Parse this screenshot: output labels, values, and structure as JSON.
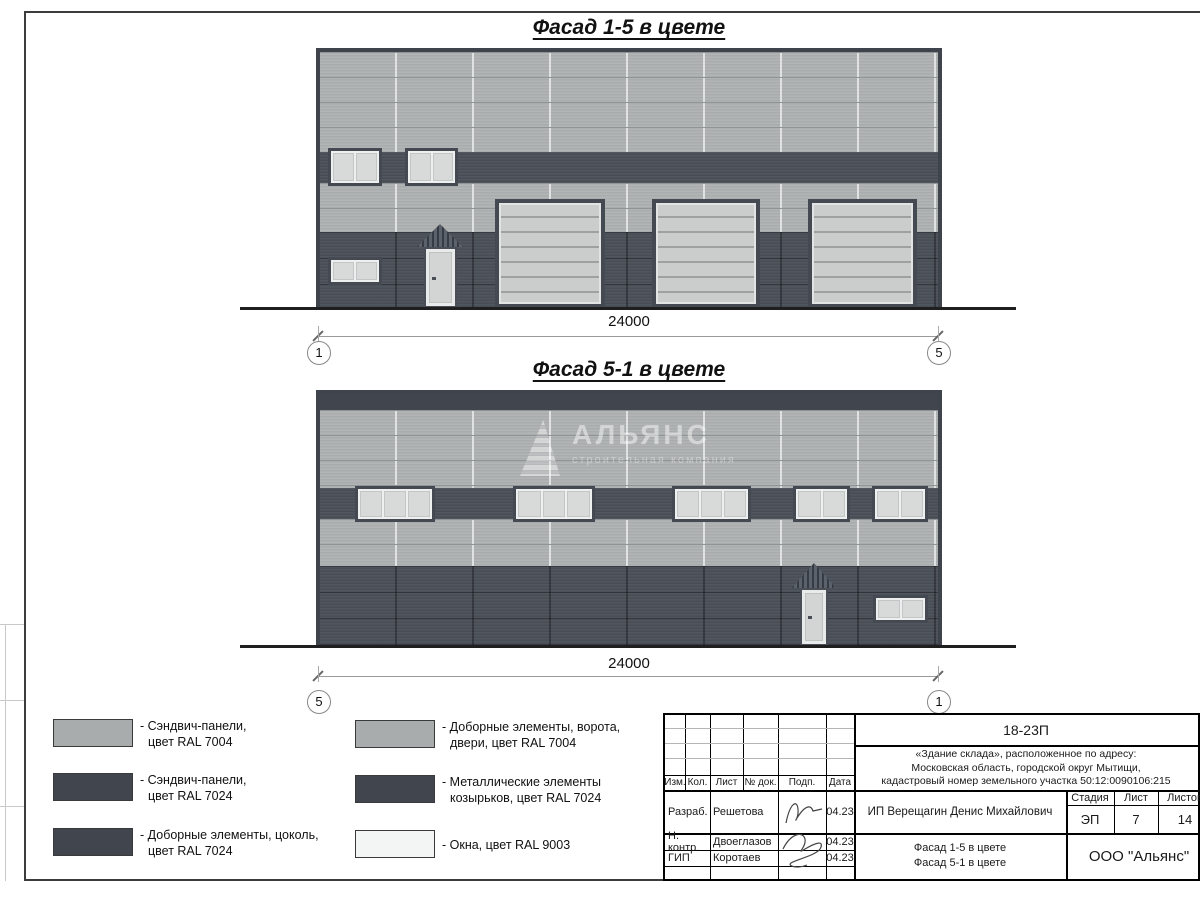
{
  "drawing": {
    "facade1": {
      "title": "Фасад 1-5 в цвете",
      "dimension": "24000",
      "axis_left": "1",
      "axis_right": "5"
    },
    "facade2": {
      "title": "Фасад 5-1 в цвете",
      "dimension": "24000",
      "axis_left": "5",
      "axis_right": "1"
    },
    "watermark": {
      "name": "АЛЬЯНС",
      "subtitle": "строительная компания"
    }
  },
  "legend": {
    "items": [
      {
        "line1": "- Сэндвич-панели,",
        "line2": "цвет RAL 7004",
        "color": "#a8acad"
      },
      {
        "line1": "- Сэндвич-панели,",
        "line2": "цвет RAL 7024",
        "color": "#41464e"
      },
      {
        "line1": "- Доборные элементы, цоколь,",
        "line2": "цвет RAL 7024",
        "color": "#41464e"
      },
      {
        "line1": "- Доборные элементы, ворота,",
        "line2": "двери, цвет RAL 7004",
        "color": "#a8acad"
      },
      {
        "line1": "- Металлические элементы",
        "line2": "козырьков, цвет RAL 7024",
        "color": "#41464e"
      },
      {
        "line1": "- Окна, цвет RAL 9003",
        "line2": "",
        "color": "#f3f4f4"
      }
    ]
  },
  "titleblock": {
    "code": "18-23П",
    "object_line1": "«Здание склада», расположенное по адресу:",
    "object_line2": "Московская область, городской округ Мытищи,",
    "object_line3": "кадастровый номер земельного участка 50:12:0090106:215",
    "header": [
      "Изм.",
      "Кол.",
      "Лист",
      "№ док.",
      "Подп.",
      "Дата"
    ],
    "rows": [
      {
        "role": "Разраб.",
        "name": "Решетова",
        "date": "04.23"
      },
      {
        "role": "Н. контр.",
        "name": "Двоеглазов",
        "date": "04.23"
      },
      {
        "role": "ГИП",
        "name": "Коротаев",
        "date": "04.23"
      }
    ],
    "client": "ИП Верещагин Денис Михайлович",
    "doc_title_line1": "Фасад 1-5 в цвете",
    "doc_title_line2": "Фасад 5-1 в цвете",
    "stage_label": "Стадия",
    "sheet_label": "Лист",
    "sheets_label": "Листов",
    "stage_value": "ЭП",
    "sheet_value": "7",
    "sheets_value": "14",
    "company": "ООО \"Альянс\""
  }
}
